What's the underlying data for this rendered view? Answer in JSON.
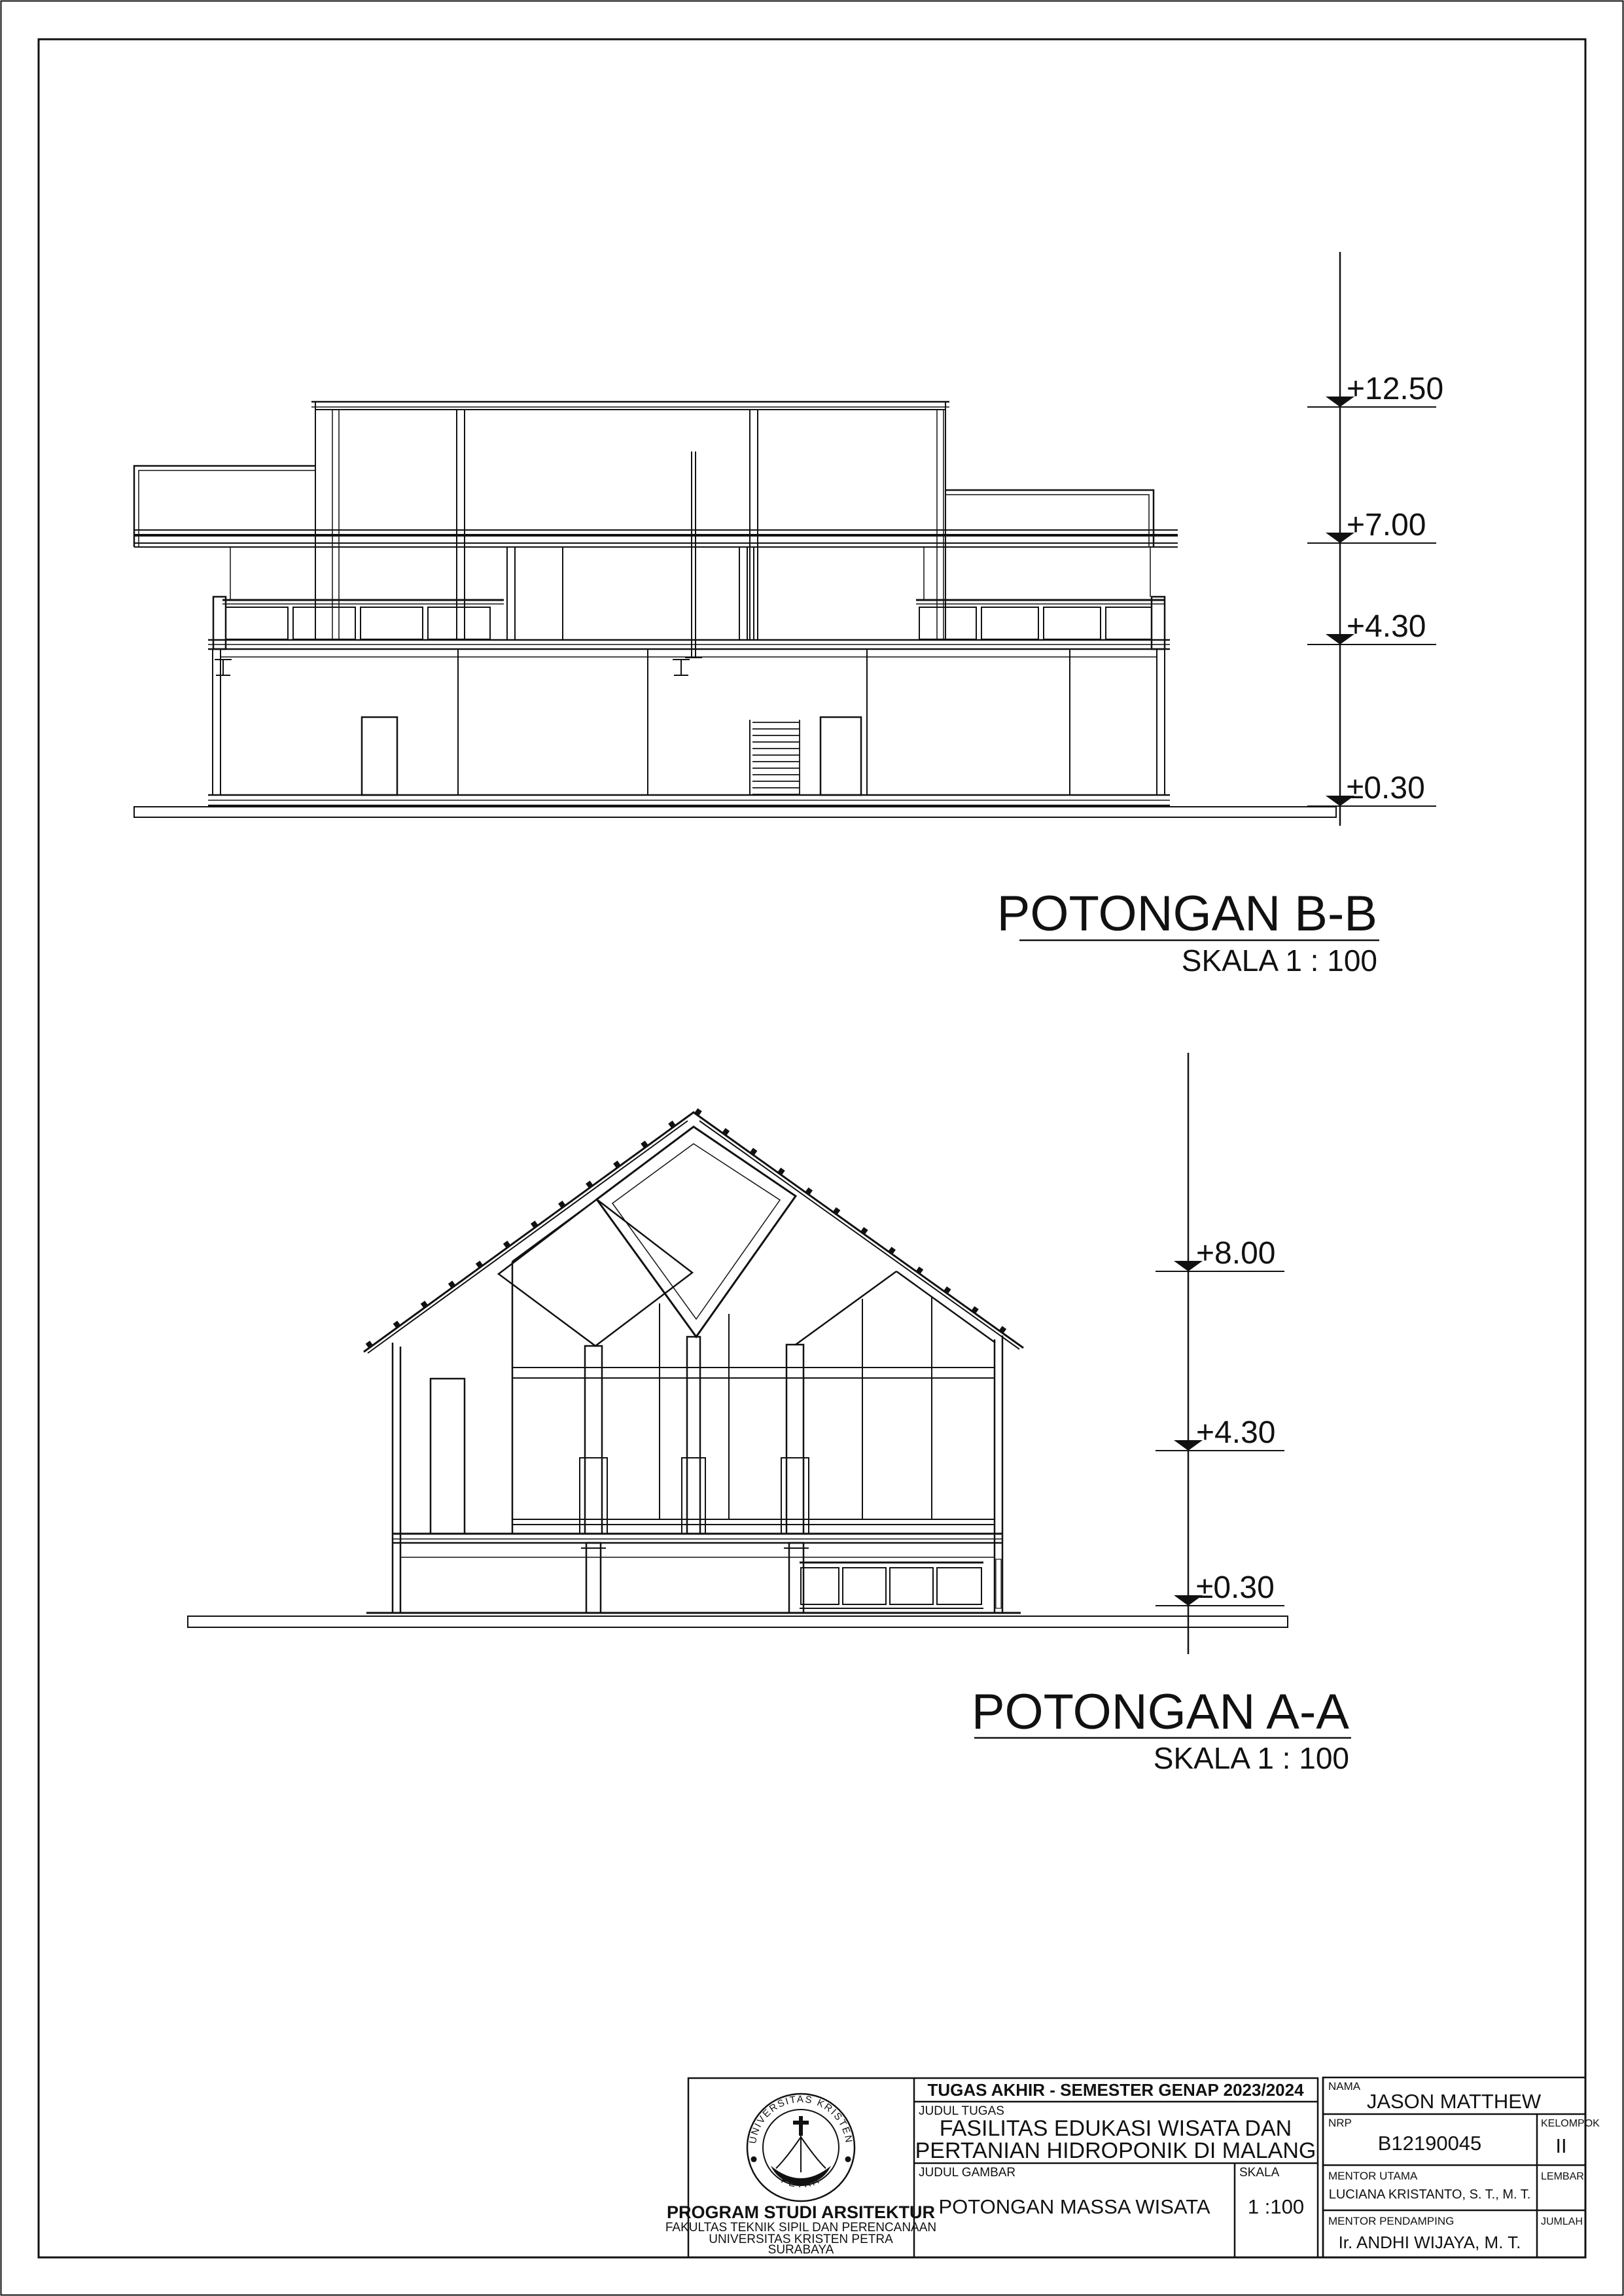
{
  "document": {
    "type": "architectural-section-sheet",
    "paper_color": "#ffffff",
    "line_color": "#111111"
  },
  "sections": {
    "bb": {
      "title": "POTONGAN B-B",
      "scale_label": "SKALA 1 : 100",
      "elevations": [
        {
          "label": "+12.50"
        },
        {
          "label": "+7.00"
        },
        {
          "label": "+4.30"
        },
        {
          "label": "±0.30"
        }
      ]
    },
    "aa": {
      "title": "POTONGAN A-A",
      "scale_label": "SKALA 1 : 100",
      "elevations": [
        {
          "label": "+8.00"
        },
        {
          "label": "+4.30"
        },
        {
          "label": "±0.30"
        }
      ]
    }
  },
  "title_block": {
    "header": "TUGAS AKHIR - SEMESTER GENAP 2023/2024",
    "judul_tugas_label": "JUDUL TUGAS",
    "judul_tugas_line1": "FASILITAS EDUKASI WISATA DAN",
    "judul_tugas_line2": "PERTANIAN HIDROPONIK DI MALANG",
    "judul_gambar_label": "JUDUL GAMBAR",
    "judul_gambar": "POTONGAN  MASSA WISATA",
    "skala_label": "SKALA",
    "skala_value": "1 :100",
    "nama_label": "NAMA",
    "nama": "JASON MATTHEW",
    "nrp_label": "NRP",
    "nrp": "B12190045",
    "kelompok_label": "KELOMPOK",
    "kelompok": "II",
    "mentor_utama_label": "MENTOR UTAMA",
    "mentor_utama": "LUCIANA KRISTANTO, S. T., M. T.",
    "lembar_label": "LEMBAR",
    "lembar": "",
    "mentor_pendamping_label": "MENTOR PENDAMPING",
    "mentor_pendamping": "Ir. ANDHI WIJAYA, M. T.",
    "jumlah_label": "JUMLAH",
    "jumlah": "",
    "institution": {
      "program": "PROGRAM STUDI ARSITEKTUR",
      "fakultas": "FAKULTAS TEKNIK SIPIL DAN PERENCANAAN",
      "universitas": "UNIVERSITAS KRISTEN PETRA",
      "kota": "SURABAYA"
    },
    "logo": {
      "arc_top": "UNIVERSITAS KRISTEN",
      "arc_bottom": "PETRA"
    }
  }
}
